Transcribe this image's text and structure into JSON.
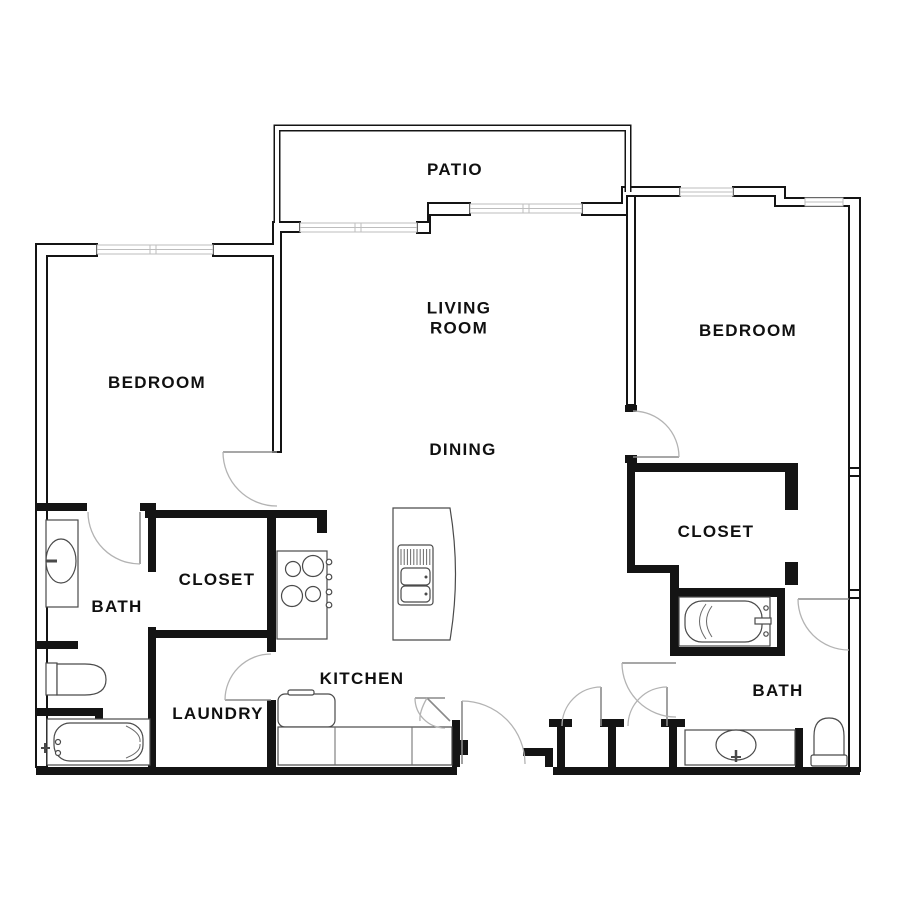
{
  "title": "2 bedroom 2 bath apartment floor plan",
  "colors": {
    "background": "#ffffff",
    "wall": "#141414",
    "window_line": "#bdbdbd",
    "door_arc": "#b3b3b3",
    "fixture_line": "#4a4a4a",
    "text": "#101010"
  },
  "rooms": [
    {
      "id": "patio",
      "label": "PATIO"
    },
    {
      "id": "living-room",
      "label": "LIVING ROOM"
    },
    {
      "id": "bedroom-left",
      "label": "BEDROOM"
    },
    {
      "id": "bedroom-right",
      "label": "BEDROOM"
    },
    {
      "id": "dining",
      "label": "DINING"
    },
    {
      "id": "closet-left",
      "label": "CLOSET"
    },
    {
      "id": "closet-right",
      "label": "CLOSET"
    },
    {
      "id": "bath-left",
      "label": "BATH"
    },
    {
      "id": "bath-right",
      "label": "BATH"
    },
    {
      "id": "kitchen",
      "label": "KITCHEN"
    },
    {
      "id": "laundry",
      "label": "LAUNDRY"
    }
  ],
  "fixtures": [
    "vanity-sink-left",
    "toilet-left",
    "bathtub-left",
    "range-stove",
    "kitchen-island-sink",
    "refrigerator",
    "kitchen-counter",
    "bathtub-right",
    "vanity-sink-right",
    "toilet-right"
  ],
  "doors": [
    "bedroom-left-door",
    "bath-left-door",
    "laundry-door",
    "entry-door",
    "entry-closet-door",
    "hall-closet-door-1",
    "hall-closet-door-2",
    "bath-right-door",
    "bedroom-right-door",
    "bedroom-right-bath-door",
    "dishwasher-door"
  ],
  "windows": [
    "bedroom-left-window",
    "living-room-window-1",
    "living-room-window-2",
    "bedroom-right-window-top",
    "bedroom-right-window-corner"
  ]
}
